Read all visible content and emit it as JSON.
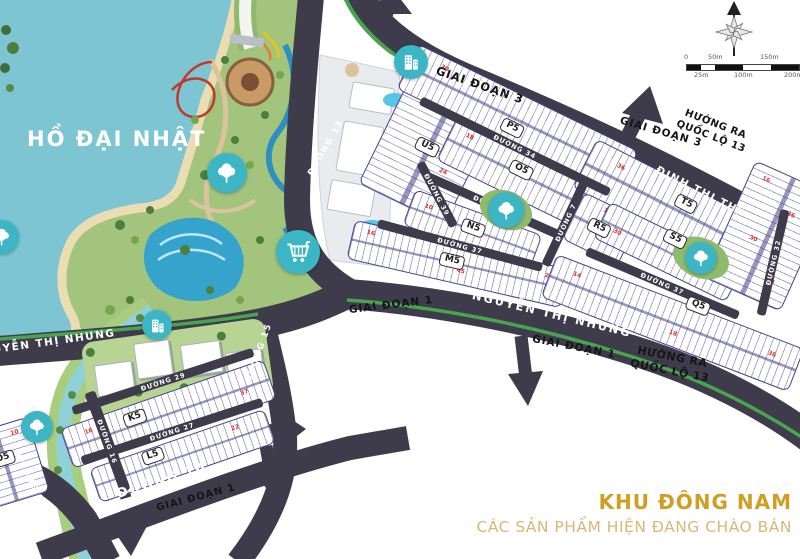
{
  "lake": {
    "label": "HỒ ĐẠI NHẬT"
  },
  "legend": {
    "area_title": "KHU ĐÔNG NAM",
    "area_subtitle": "CÁC SẢN PHẨM HIỆN ĐANG CHÀO BÁN",
    "title_color": "#cf9e22",
    "subtitle_color": "#d8b874"
  },
  "roads": {
    "dinh_thi_thi": "ĐINH THỊ THI",
    "nguyen_thi_nhung": "NGUYỄN THỊ NHUNG",
    "duong_7": "ĐƯỜNG 7",
    "duong_10": "ĐƯỜNG 10",
    "duong_13": "ĐƯỜNG 13",
    "duong_15": "ĐƯỜNG 15",
    "duong_16": "ĐƯỜNG 16",
    "duong_18": "ĐƯỜNG 18",
    "duong_27": "ĐƯỜNG 27",
    "duong_29": "ĐƯỜNG 29",
    "duong_32": "ĐƯỜNG 32",
    "duong_34": "ĐƯỜNG 34",
    "duong_35": "ĐƯỜNG 35",
    "duong_37": "ĐƯỜNG 37",
    "duong_39": "ĐƯỜNG 39"
  },
  "phases": {
    "phase_1": "GIAI ĐOẠN 1",
    "phase_3": "GIAI ĐOẠN 3"
  },
  "directions": {
    "ql13": "HƯỚNG RA QUỐC LỘ 13"
  },
  "blocks": {
    "u5": "U5",
    "p5": "P5",
    "o5": "O5",
    "n5": "N5",
    "m5": "M5",
    "t5": "T5",
    "r5": "R5",
    "s5": "S5",
    "q5": "Q5",
    "k5": "K5",
    "l5": "L5",
    "o5_west": "O5"
  },
  "scale_bar": {
    "top_labels": [
      "0",
      "50m",
      "150m"
    ],
    "bottom_labels": [
      "25m",
      "100m",
      "200m"
    ]
  },
  "lot_numbers": [
    "16",
    "36",
    "30",
    "18",
    "10",
    "24",
    "45",
    "14",
    "22",
    "37",
    "64",
    "12"
  ],
  "icons": {
    "tree": "tree-icon",
    "shopping_cart": "cart-icon",
    "building": "building-icon",
    "compass": "compass-rose-icon",
    "arrows": "road-direction-arrow"
  },
  "colors": {
    "water": "#7ec5d4",
    "park": "#a3c47c",
    "road": "#3e3b4b",
    "median_green": "#4aa351",
    "block_border": "#45408a",
    "marker_teal": "#3cb6c4",
    "lot_number_red": "#e03030"
  }
}
